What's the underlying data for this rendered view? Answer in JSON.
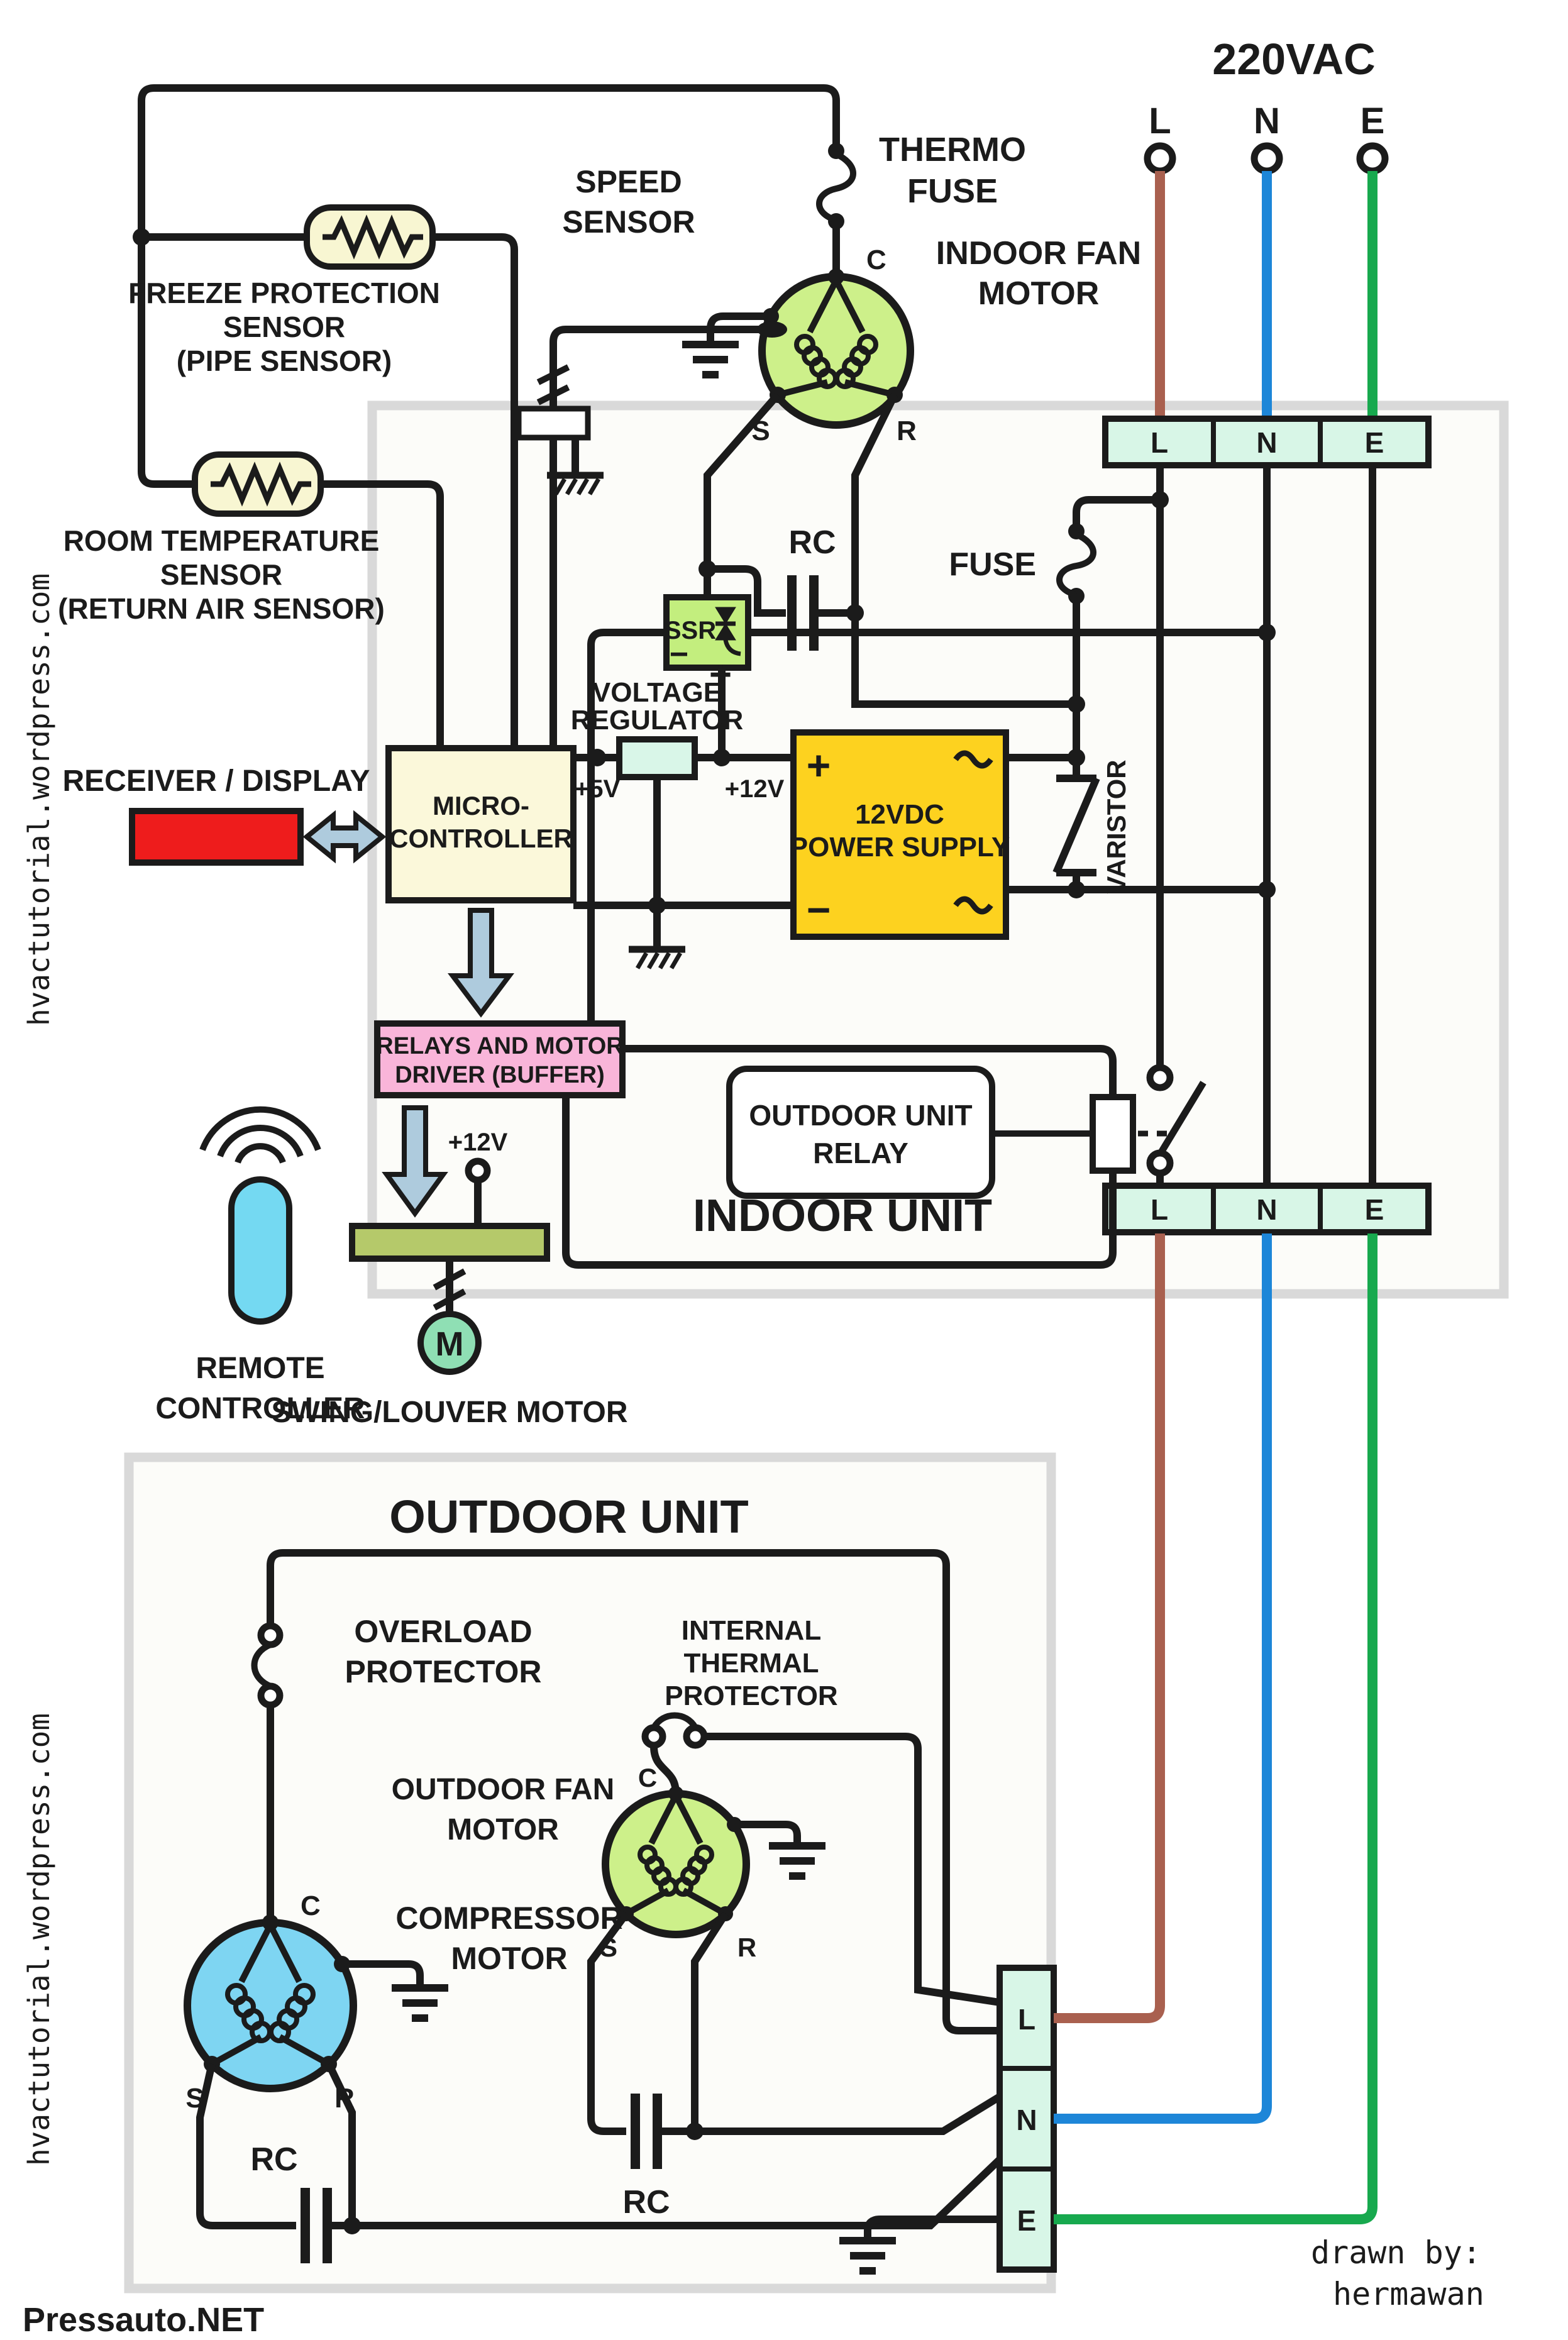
{
  "labels": {
    "power": "220VAC",
    "t": {
      "l": "L",
      "n": "N",
      "e": "E"
    },
    "thermo": [
      "THERMO",
      "FUSE"
    ],
    "speed": [
      "SPEED",
      "SENSOR"
    ],
    "indoor_fan": [
      "INDOOR FAN",
      "MOTOR"
    ],
    "freeze": [
      "FREEZE PROTECTION",
      "SENSOR",
      "(PIPE SENSOR)"
    ],
    "room": [
      "ROOM TEMPERATURE",
      "SENSOR",
      "(RETURN AIR SENSOR)"
    ],
    "fuse": "FUSE",
    "rc": "RC",
    "ssr": "SSR",
    "minus": "−",
    "plus": "+",
    "vreg": [
      "VOLTAGE",
      "REGULATOR"
    ],
    "v5": "+5V",
    "v12": "+12V",
    "psu": [
      "12VDC",
      "POWER SUPPLY"
    ],
    "varistor": "VARISTOR",
    "mcu": [
      "MICRO-",
      "CONTROLLER"
    ],
    "receiver": "RECEIVER / DISPLAY",
    "remote": [
      "REMOTE",
      "CONTROLLER"
    ],
    "relays": [
      "RELAYS AND MOTOR",
      "DRIVER (BUFFER)"
    ],
    "ou_relay": [
      "OUTDOOR UNIT",
      "RELAY"
    ],
    "indoor_unit": "INDOOR UNIT",
    "outdoor_unit": "OUTDOOR UNIT",
    "swing": "SWING/LOUVER MOTOR",
    "m": "M",
    "pins": {
      "c": "C",
      "s": "S",
      "r": "R"
    },
    "overload": [
      "OVERLOAD",
      "PROTECTOR"
    ],
    "itp": [
      "INTERNAL",
      "THERMAL",
      "PROTECTOR"
    ],
    "outdoor_fan": [
      "OUTDOOR FAN",
      "MOTOR"
    ],
    "compressor": [
      "COMPRESSOR",
      "MOTOR"
    ],
    "credit": [
      "drawn by:",
      "hermawan"
    ],
    "watermark": "hvactutorial.wordpress.com",
    "site": "Pressauto.NET"
  },
  "colors": {
    "wire_l": "#a9604f",
    "wire_n": "#1d86d8",
    "wire_e": "#17a94e",
    "mint": "#d8f6e7",
    "cream": "#f8f6d2",
    "fan_green": "#cdf08a",
    "compressor_blue": "#7ed5f2",
    "psu_yellow": "#fdd21f",
    "pink": "#f9b5d9",
    "mcu_cream": "#fbf8da",
    "vr_mint": "#d9f6e8",
    "red": "#ee1c1c",
    "arrow": "#aecbdd",
    "remote_cyan": "#74d9f2",
    "swing_bar": "#b5c96a",
    "m_green": "#8fdfb4",
    "ssr_green": "#c3ee7e",
    "site_blue": "#2851b8",
    "border_gray": "#d9d9d9",
    "box_fill": "#fcfcf9"
  }
}
